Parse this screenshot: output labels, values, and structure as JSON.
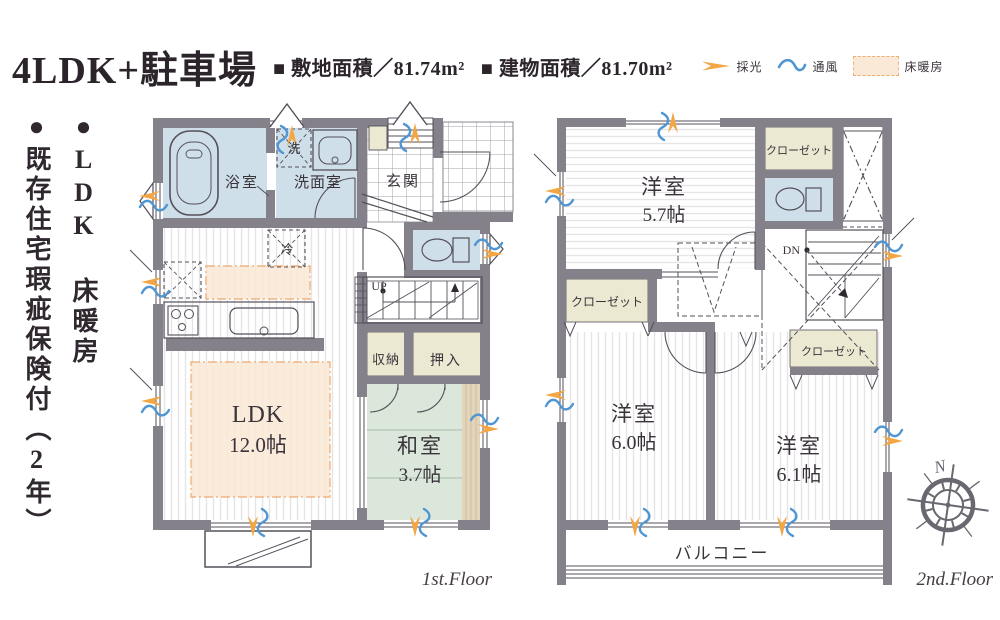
{
  "header": {
    "title": "4LDK+駐車場",
    "site_area": "■ 敷地面積／81.74m²",
    "building_area": "■ 建物面積／81.70m²",
    "legend": {
      "daylight": "採光",
      "ventilation": "通風",
      "floor_heating": "床暖房"
    }
  },
  "side_notes": {
    "line1": "●LDK 床暖房",
    "line2": "●既存住宅瑕疵保険付（2年）"
  },
  "floor1": {
    "caption": "1st.Floor",
    "bathroom": "浴室",
    "laundry": "洗",
    "washroom": "洗面室",
    "entrance": "玄関",
    "refrigerator": "冷",
    "stairs_up": "UP",
    "storage": "収納",
    "oshiire": "押入",
    "ldk": "LDK",
    "ldk_size": "12.0帖",
    "japanese_room": "和室",
    "japanese_room_size": "3.7帖"
  },
  "floor2": {
    "caption": "2nd.Floor",
    "western_room_a": "洋室",
    "western_room_a_size": "5.7帖",
    "closet_a": "クローゼット",
    "stairs_down": "DN",
    "closet_b": "クローゼット",
    "western_room_b": "洋室",
    "western_room_b_size": "6.0帖",
    "closet_c": "クローゼット",
    "western_room_c": "洋室",
    "western_room_c_size": "6.1帖",
    "balcony": "バルコニー"
  },
  "compass": {
    "north_label": "N"
  },
  "colors": {
    "wall": "#84818a",
    "water_room": "#cfdfe9",
    "closet_room": "#ece9d3",
    "tatami_room": "#dbe7da",
    "tatami_edge": "#e3d5bb",
    "floor_heating_fill": "#fbe9d8",
    "floor_heating_border": "#eeaf76",
    "daylight_arrow": "#f2a644",
    "ventilation_wave": "#4f96d2",
    "outline": "#55505a",
    "text": "#39333a"
  }
}
